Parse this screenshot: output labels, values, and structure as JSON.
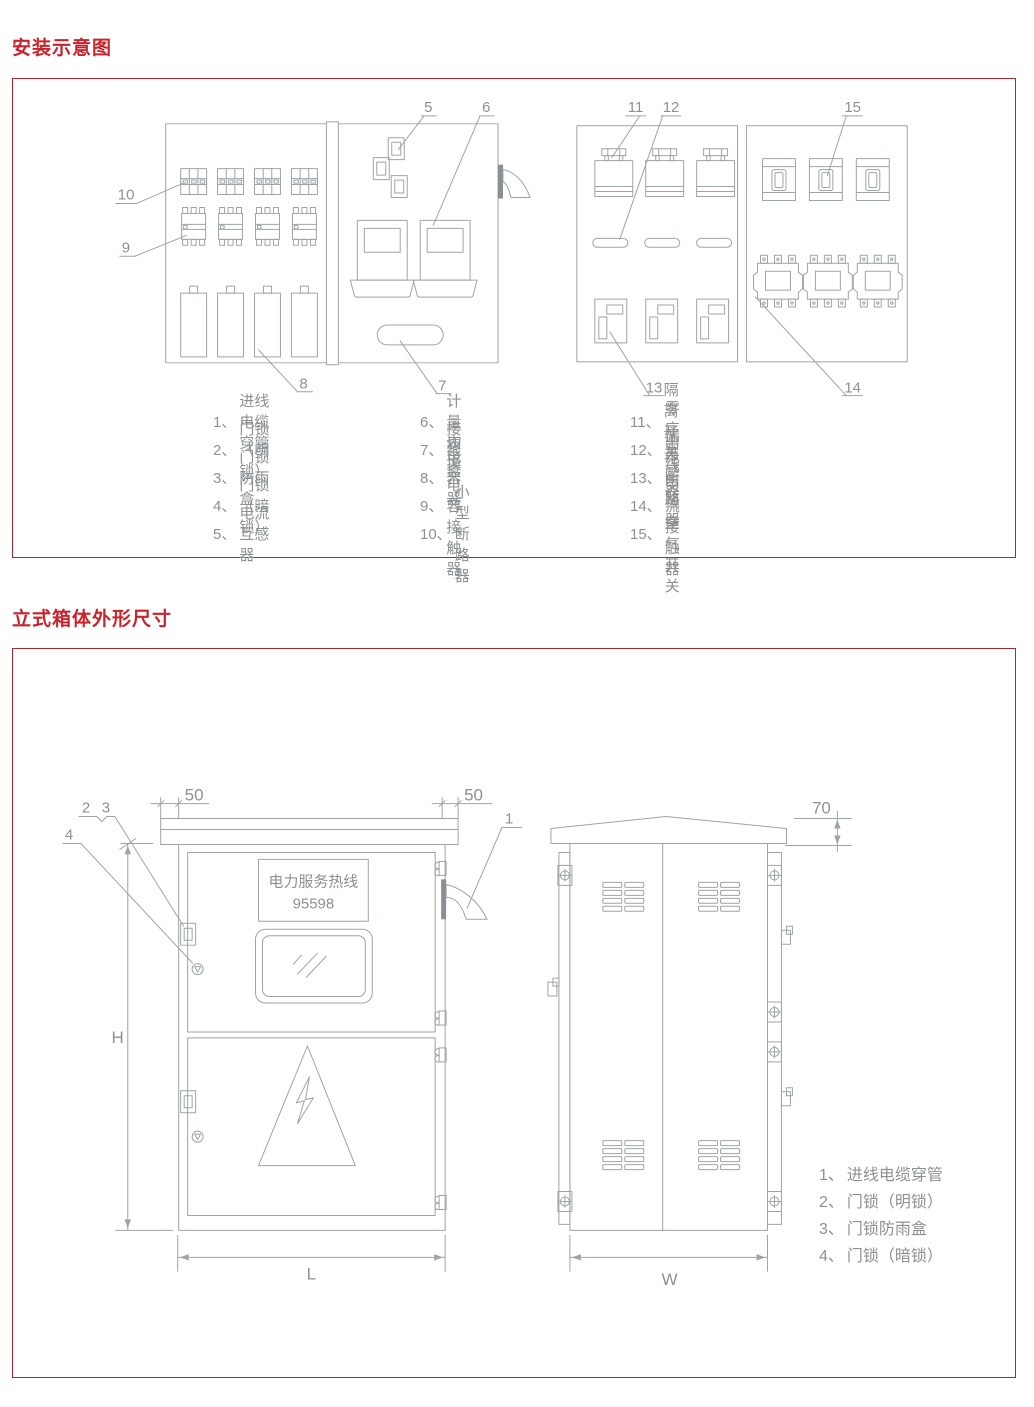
{
  "page": {
    "section1_title": "安装示意图",
    "section2_title": "立式箱体外形尺寸"
  },
  "colors": {
    "title_red": "#C9232B",
    "border_red": "#A8272F",
    "line_gray": "#9EA4A7",
    "text_gray": "#8D9194"
  },
  "diagram1": {
    "callouts": {
      "c5": "5",
      "c6": "6",
      "c7": "7",
      "c8": "8",
      "c9": "9",
      "c10": "10",
      "c11": "11",
      "c12": "12",
      "c13": "13",
      "c14": "14",
      "c15": "15"
    }
  },
  "legend1": {
    "columns": [
      {
        "items": [
          {
            "num": "1、",
            "label": "进线电缆穿管"
          },
          {
            "num": "2、",
            "label": "门锁（明锁）"
          },
          {
            "num": "3、",
            "label": "门锁防雨盒"
          },
          {
            "num": "4、",
            "label": "门锁（暗锁）"
          },
          {
            "num": "5、",
            "label": "电流互感器"
          }
        ]
      },
      {
        "items": [
          {
            "num": "6、",
            "label": "计量表"
          },
          {
            "num": "7、",
            "label": "接线盒"
          },
          {
            "num": "8、",
            "label": "电容器"
          },
          {
            "num": "9、",
            "label": "切换电容接触器"
          },
          {
            "num": "10、",
            "label": "小型断路器"
          }
        ]
      },
      {
        "items": [
          {
            "num": "11、",
            "label": "隔离开关"
          },
          {
            "num": "12、",
            "label": "零序互感器"
          },
          {
            "num": "13、",
            "label": "漏电断路器"
          },
          {
            "num": "14、",
            "label": "出线交流接触器"
          },
          {
            "num": "15、",
            "label": "出线空气开关"
          }
        ]
      }
    ]
  },
  "cabinet": {
    "plate_line1": "电力服务热线",
    "plate_line2": "95598",
    "dims": {
      "left_overhang": "50",
      "right_overhang": "50",
      "roof_rise": "70",
      "height": "H",
      "length": "L",
      "width": "W"
    },
    "callouts": {
      "c1": "1",
      "c2": "2",
      "c3": "3",
      "c4": "4"
    }
  },
  "legend2": {
    "items": [
      {
        "num": "1、",
        "label": "进线电缆穿管"
      },
      {
        "num": "2、",
        "label": "门锁（明锁）"
      },
      {
        "num": "3、",
        "label": "门锁防雨盒"
      },
      {
        "num": "4、",
        "label": "门锁（暗锁）"
      }
    ]
  }
}
